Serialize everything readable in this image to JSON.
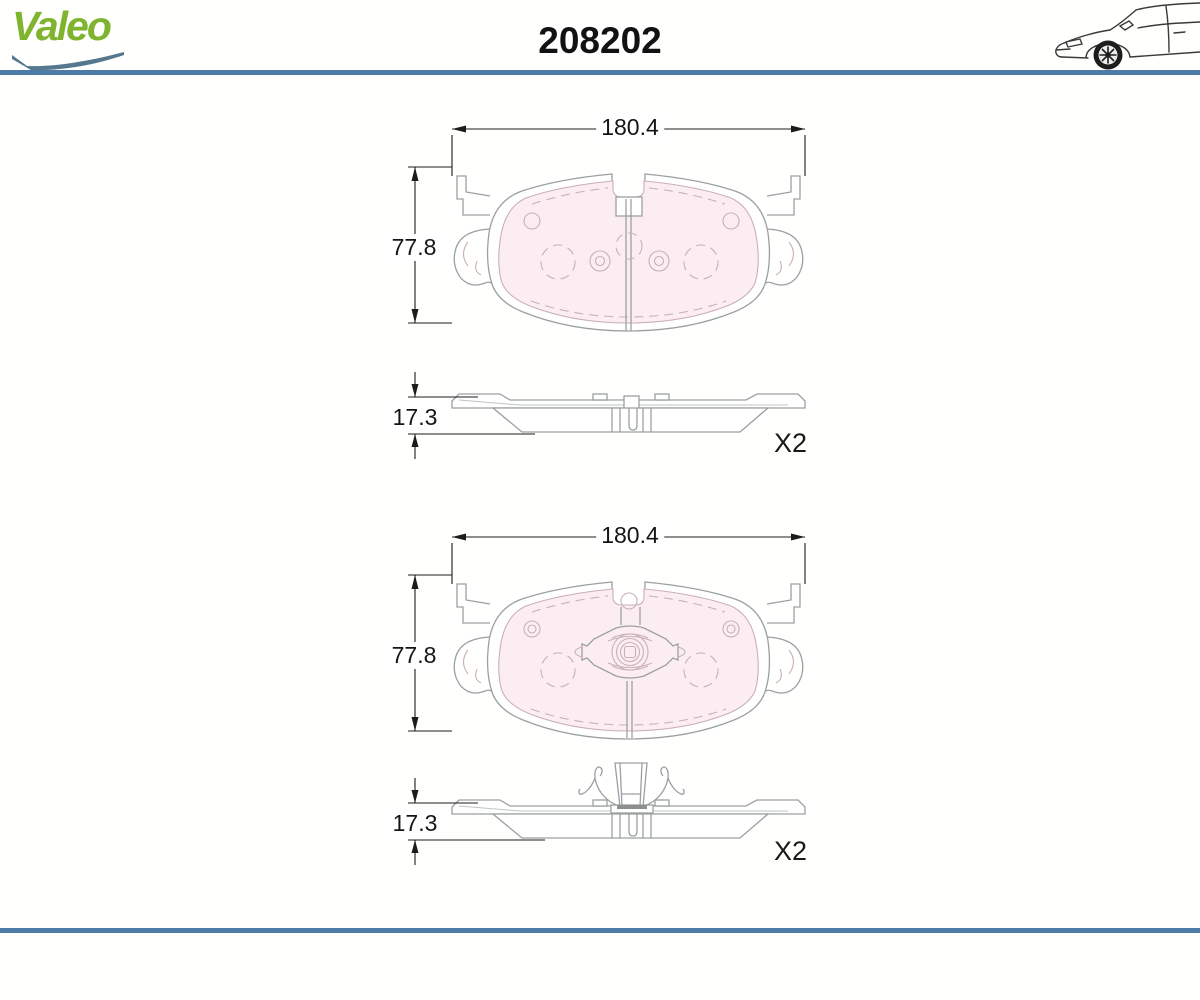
{
  "header": {
    "brand": "Valeo",
    "part_number": "208202",
    "icons": {
      "car": "car-side-icon",
      "swoosh": "brand-swoosh-icon"
    }
  },
  "colors": {
    "rule_blue": "#4e7ba6",
    "logo_green": "#7fb52e",
    "swoosh_blue": "#56788f",
    "pad_friction_pink": "#fcedf2",
    "drawing_line_gray": "#9aa0a2",
    "dimension_black": "#1c1c1c"
  },
  "drawings": [
    {
      "name": "brake-pad-front-and-side-view",
      "width_mm": "180.4",
      "height_mm": "77.8",
      "thickness_mm": "17.3",
      "quantity": "X2"
    },
    {
      "name": "brake-pad-with-wear-indicator-and-spring-front-and-side-view",
      "width_mm": "180.4",
      "height_mm": "77.8",
      "thickness_mm": "17.3",
      "quantity": "X2"
    }
  ]
}
